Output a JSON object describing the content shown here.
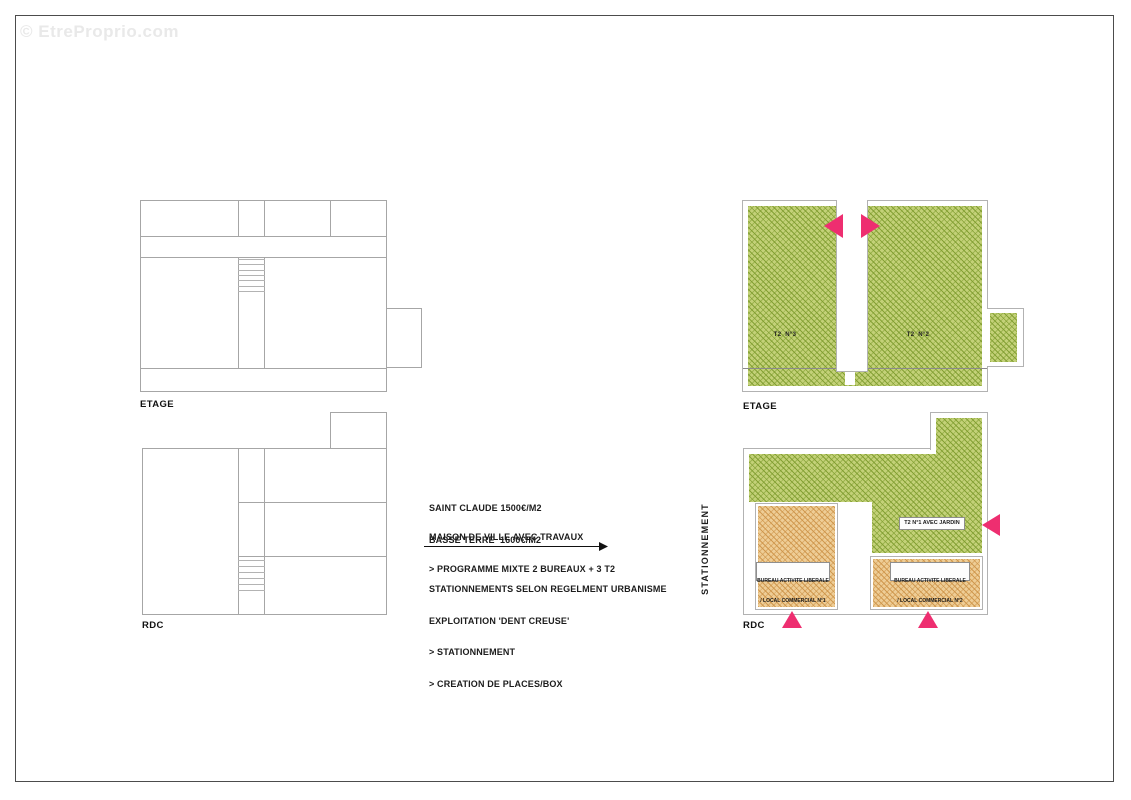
{
  "watermark": "© EtreProprio.com",
  "left_etage": {
    "label": "ETAGE"
  },
  "left_rdc": {
    "label": "RDC"
  },
  "right_etage": {
    "label": "ETAGE",
    "unit_t2n3": "T2  N°3",
    "unit_t2n2": "T2  N°2"
  },
  "right_rdc": {
    "label": "RDC",
    "unit_t2n1": "T2 N°1 AVEC JARDIN",
    "bureau1": {
      "line1": "BUREAU ACTIVITE LIBERALE",
      "line2": "/ LOCAL COMMERCIAL N°1"
    },
    "bureau2": {
      "line1": "BUREAU ACTIVITE LIBERALE",
      "line2": "/ LOCAL COMMERCIAL N°2"
    }
  },
  "annotations": {
    "price_line1": "SAINT CLAUDE 1500€/M2",
    "price_line2": "BASSE TERRE  1600€/M2",
    "program_line1": "MAISON DE VILLE AVEC TRAVAUX",
    "program_line2": "> PROGRAMME MIXTE 2 BUREAUX + 3 T2",
    "parking_line1": "STATIONNEMENTS SELON REGELMENT URBANISME",
    "parking_line2": "EXPLOITATION 'DENT CREUSE'",
    "parking_line3": "> STATIONNEMENT",
    "parking_line4": "> CREATION DE PLACES/BOX",
    "vertical_label": "STATIONNEMENT"
  },
  "icons": {
    "entrance_marker": "pink-triangle",
    "flow_arrow": "right-arrow"
  },
  "colors": {
    "green_fill": "#c3d178",
    "green_hatch": "#7e9c2e",
    "orange_fill": "#eecd96",
    "orange_hatch": "#cd9348",
    "entrance_pink": "#ee2e70",
    "plan_outline": "#a6a6a6",
    "frame_border": "#4c4c4c",
    "watermark_gray": "#e9e9e9"
  }
}
